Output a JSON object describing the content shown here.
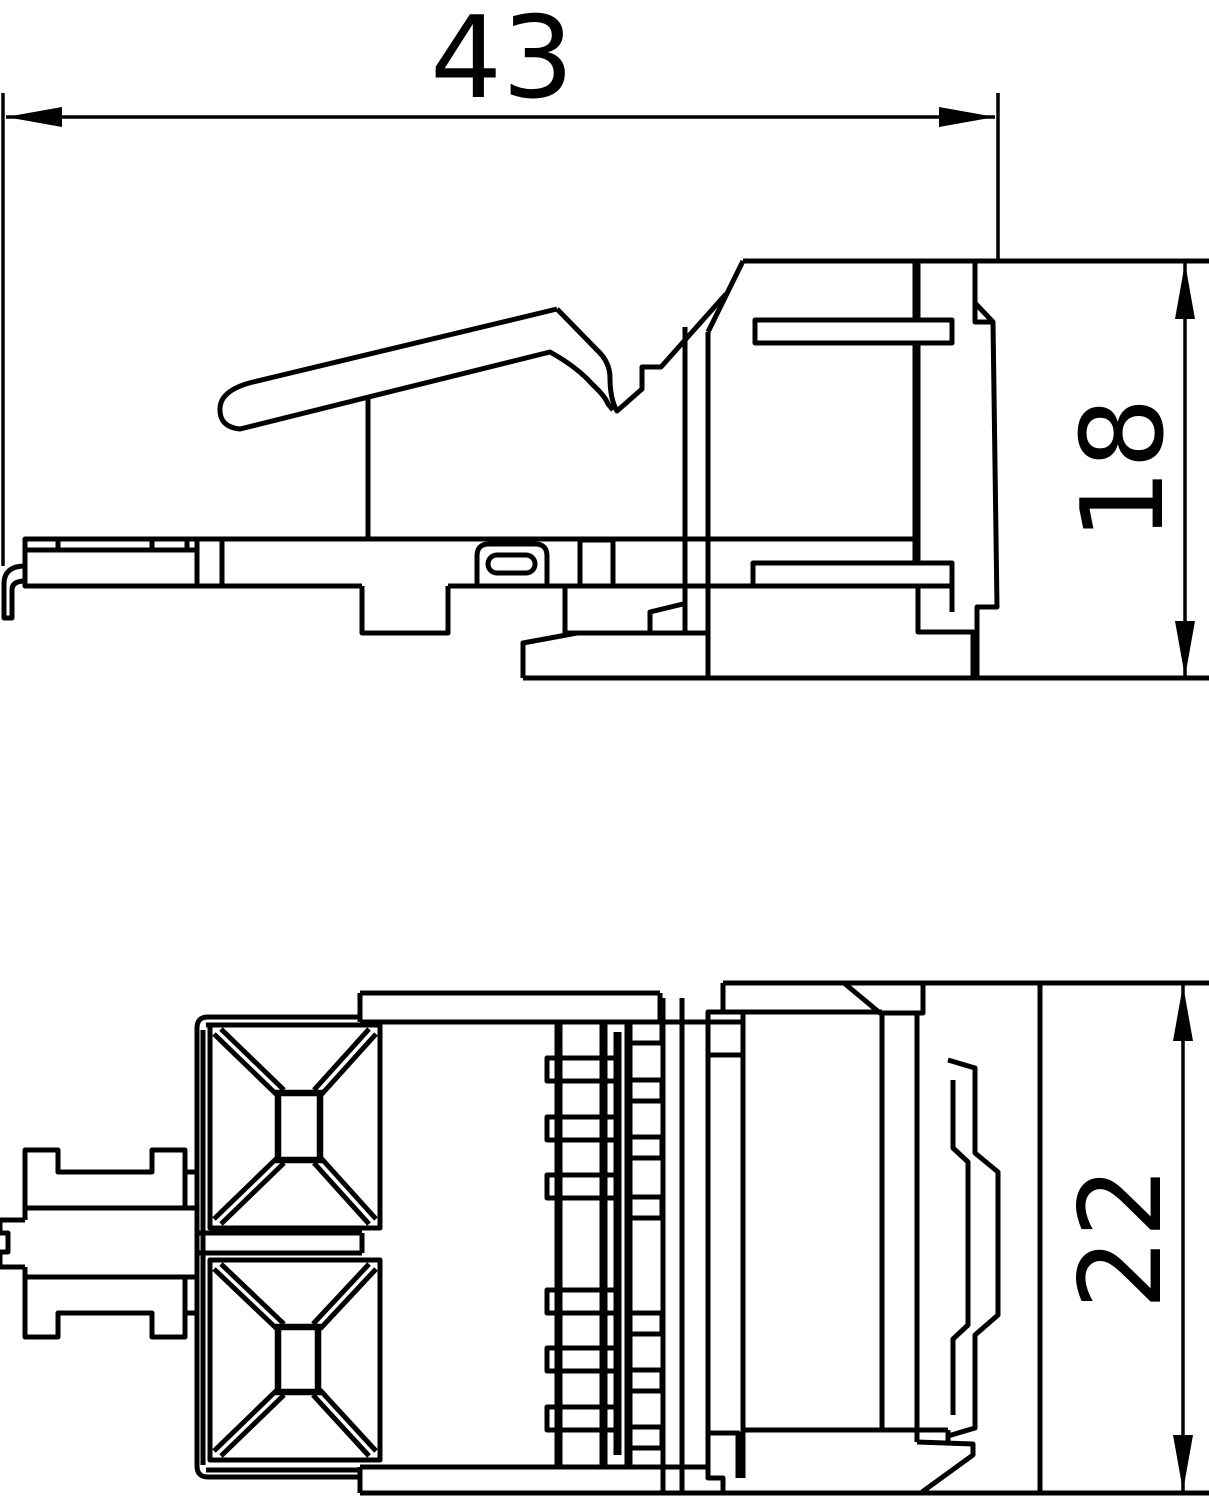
{
  "drawing": {
    "kind": "technical-dimension-drawing",
    "background": "#ffffff",
    "line_color": "#000000",
    "views": {
      "side_view": {
        "name": "side-view-top",
        "description": "connector module side elevation with latch lever"
      },
      "plan_view": {
        "name": "plan-view-bottom",
        "description": "connector module rear/plan view with wire funnels and IDC comb"
      }
    },
    "dimensions": {
      "width": {
        "value": "43",
        "orientation": "horizontal",
        "applies_to": "side_view"
      },
      "side_height": {
        "value": "18",
        "orientation": "vertical",
        "applies_to": "side_view"
      },
      "front_height": {
        "value": "22",
        "orientation": "vertical",
        "applies_to": "plan_view"
      }
    }
  }
}
